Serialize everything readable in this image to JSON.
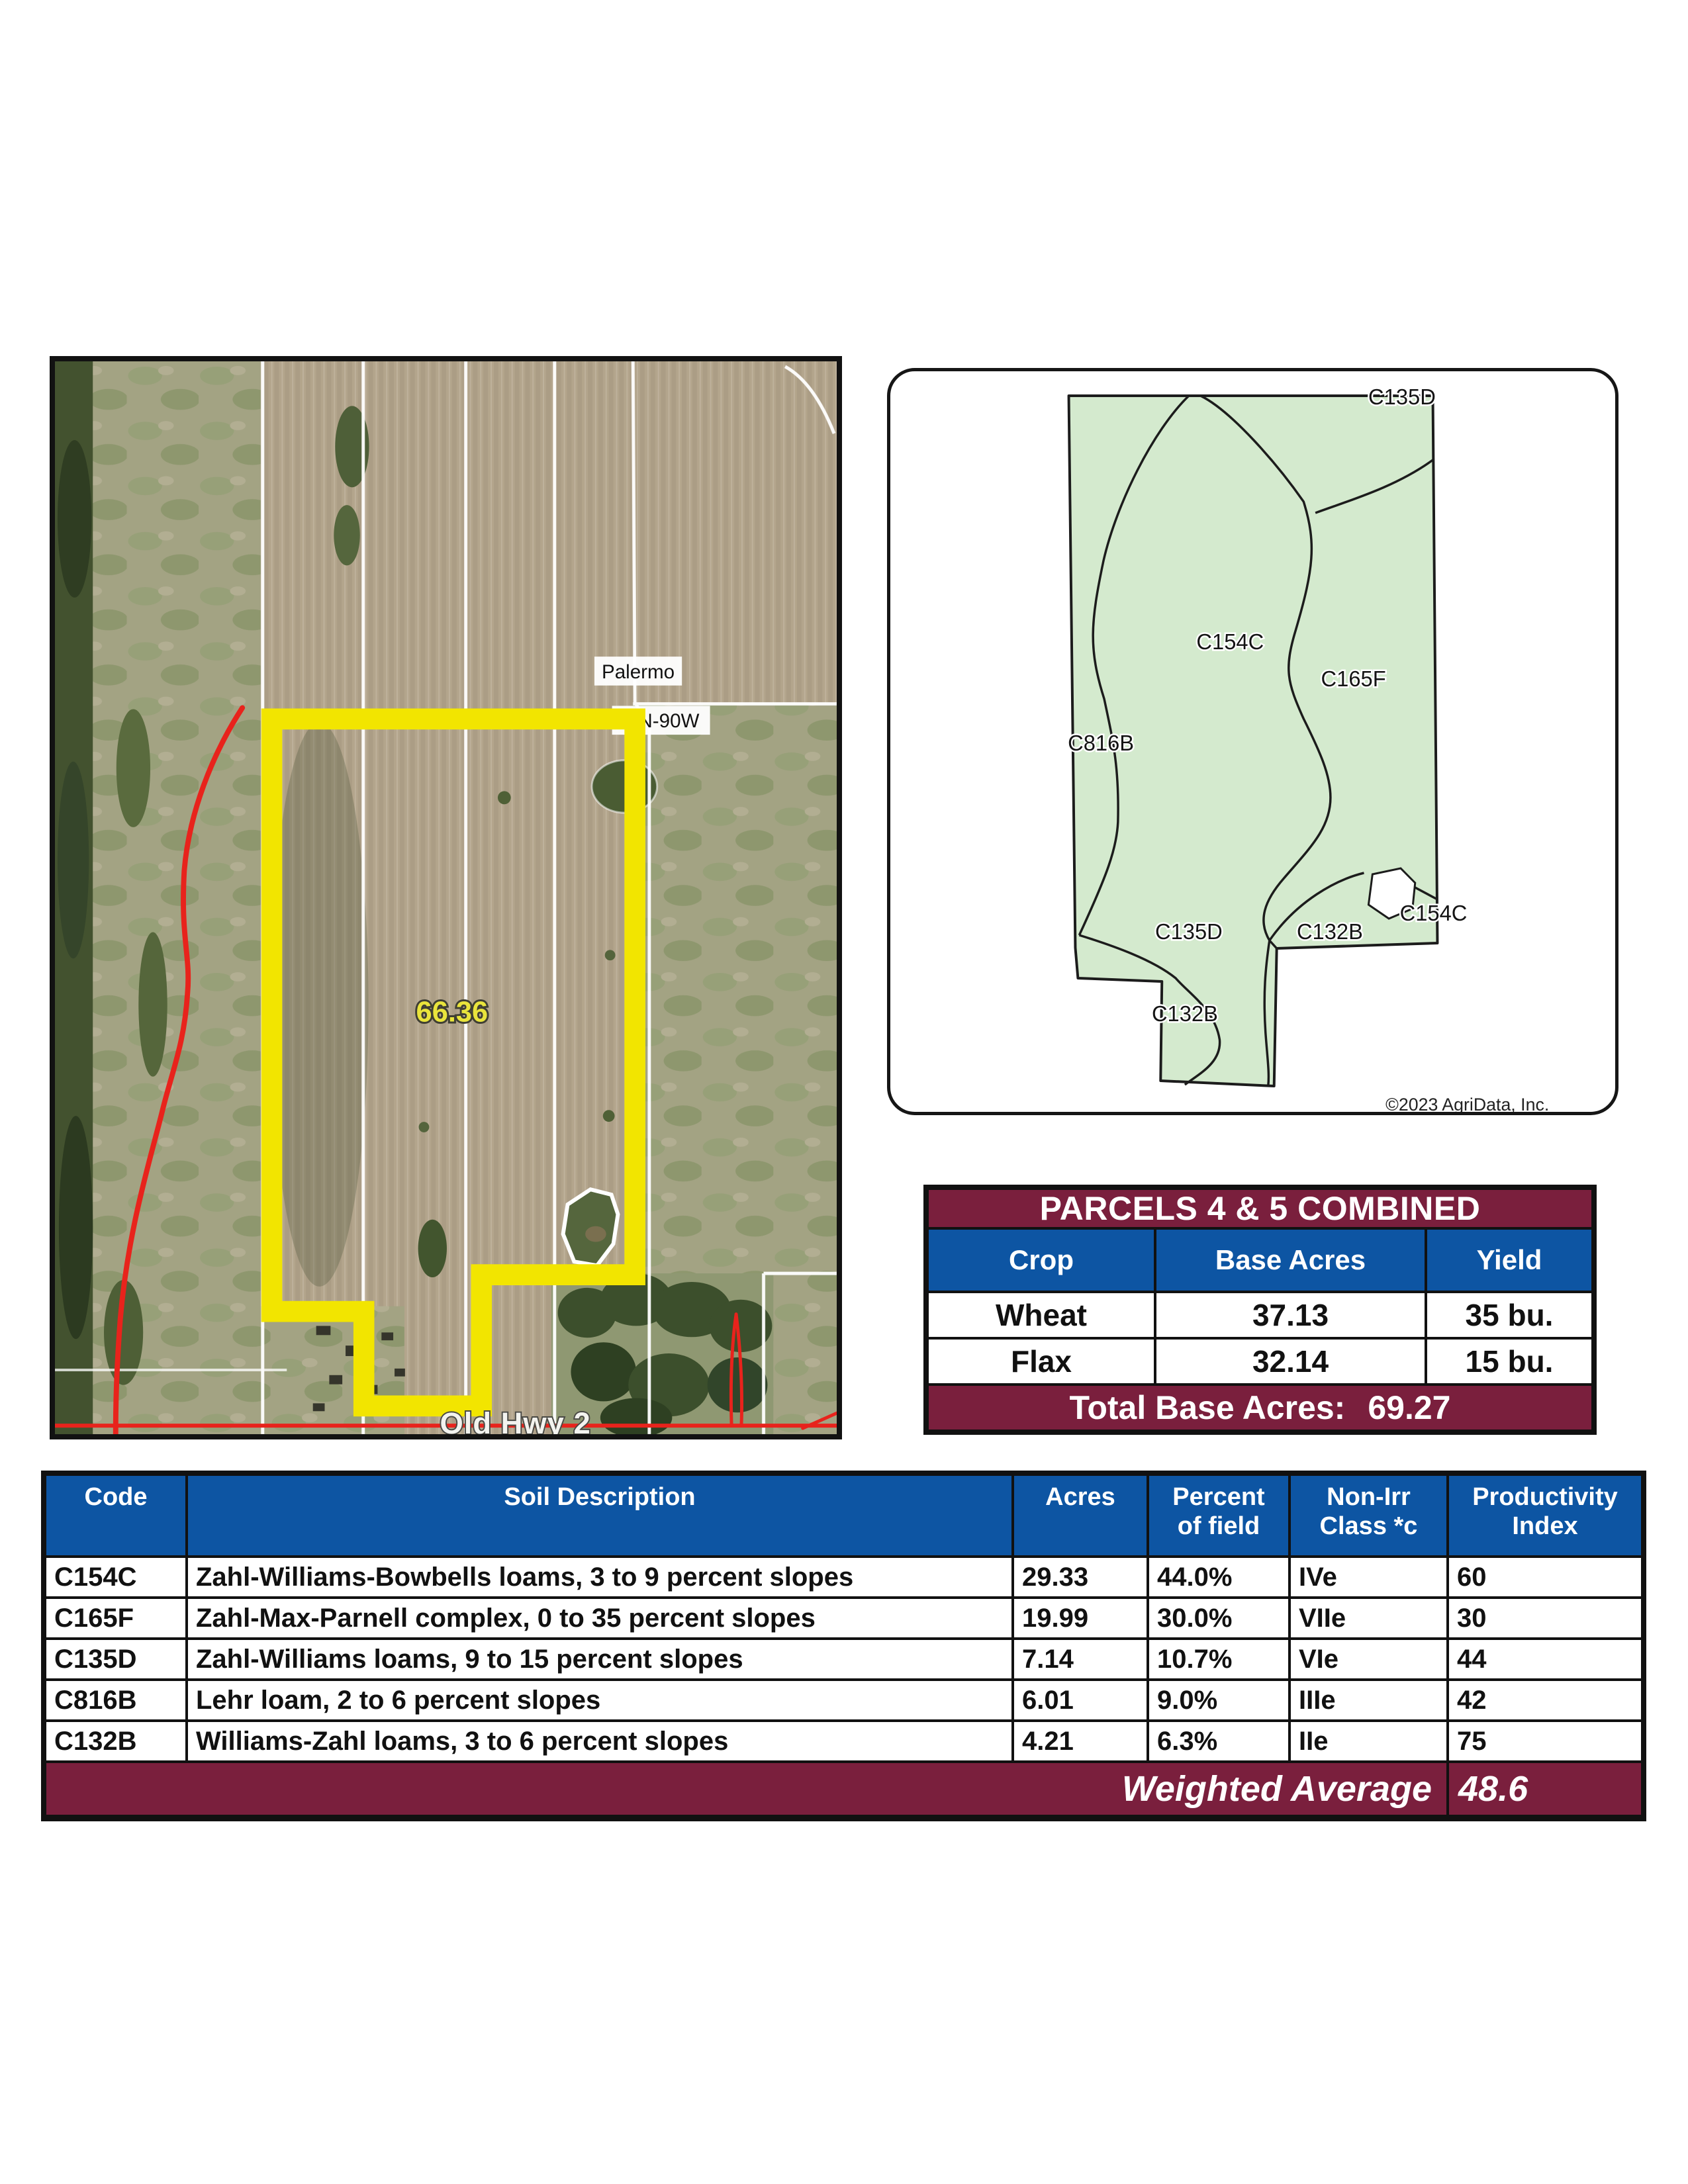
{
  "colors": {
    "maroon": "#7A1F3D",
    "blue": "#0D55A3",
    "parcel_yellow": "#F2E500",
    "soil_green": "#D4EACE",
    "overlay_red": "#E8231C"
  },
  "aerial_map": {
    "town_label": "Palermo",
    "road_label_top": "N-90W",
    "acreage_label": "66.36",
    "road_label_bottom": "Old Hwy 2"
  },
  "soil_map": {
    "region_labels": [
      "C135D",
      "C154C",
      "C165F",
      "C816B",
      "C135D",
      "C132B",
      "C154C",
      "C132B"
    ],
    "copyright": "©2023 AgriData, Inc."
  },
  "parcels_table": {
    "title": "PARCELS 4 & 5 COMBINED",
    "columns": [
      "Crop",
      "Base Acres",
      "Yield"
    ],
    "rows": [
      {
        "crop": "Wheat",
        "base_acres": "37.13",
        "yield": "35 bu."
      },
      {
        "crop": "Flax",
        "base_acres": "32.14",
        "yield": "15 bu."
      }
    ],
    "total_label": "Total Base Acres:",
    "total_value": "69.27"
  },
  "soil_table": {
    "columns": [
      {
        "l1": "Code",
        "l2": ""
      },
      {
        "l1": "Soil Description",
        "l2": ""
      },
      {
        "l1": "Acres",
        "l2": ""
      },
      {
        "l1": "Percent",
        "l2": "of field"
      },
      {
        "l1": "Non-Irr",
        "l2": "Class *c"
      },
      {
        "l1": "Productivity",
        "l2": "Index"
      }
    ],
    "rows": [
      {
        "code": "C154C",
        "description": "Zahl-Williams-Bowbells loams, 3 to 9 percent slopes",
        "acres": "29.33",
        "percent": "44.0%",
        "non_irr": "IVe",
        "pi": "60"
      },
      {
        "code": "C165F",
        "description": "Zahl-Max-Parnell complex, 0 to 35 percent slopes",
        "acres": "19.99",
        "percent": "30.0%",
        "non_irr": "VIIe",
        "pi": "30"
      },
      {
        "code": "C135D",
        "description": "Zahl-Williams loams, 9 to 15 percent slopes",
        "acres": "7.14",
        "percent": "10.7%",
        "non_irr": "VIe",
        "pi": "44"
      },
      {
        "code": "C816B",
        "description": "Lehr loam, 2 to 6 percent slopes",
        "acres": "6.01",
        "percent": "9.0%",
        "non_irr": "IIIe",
        "pi": "42"
      },
      {
        "code": "C132B",
        "description": "Williams-Zahl loams, 3 to 6 percent slopes",
        "acres": "4.21",
        "percent": "6.3%",
        "non_irr": "IIe",
        "pi": "75"
      }
    ],
    "footer_label": "Weighted Average",
    "footer_value": "48.6"
  }
}
